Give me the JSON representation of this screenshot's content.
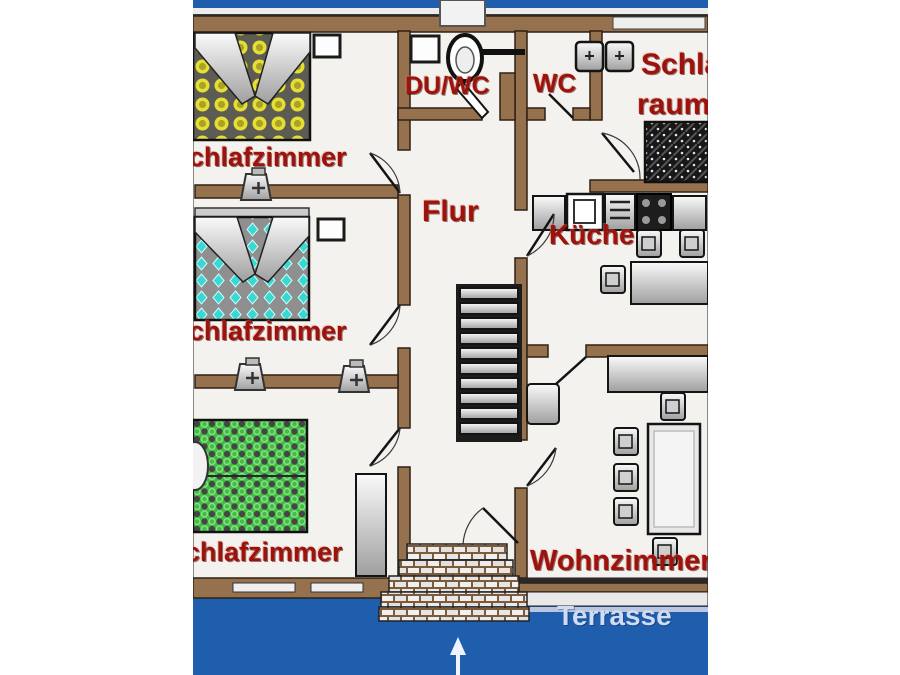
{
  "palette": {
    "page-bg": "#ffffff",
    "scan-blue": "#1f5dad",
    "wall-brown": "#96714d",
    "wall-edge": "#2f2113",
    "plan-white": "#f4f2ee",
    "label-red": "#9c130d",
    "terrace-text": "#cfdcf2"
  },
  "rooms": {
    "bedroom_top": {
      "label": "Schlafzimmer"
    },
    "bedroom_middle": {
      "label": "Schlafzimmer"
    },
    "bedroom_bottom": {
      "label": "Schlafzimmer"
    },
    "hallway": {
      "label": "Flur"
    },
    "shower_wc": {
      "label": "DU/WC"
    },
    "wc": {
      "label": "WC"
    },
    "sleeping_room": {
      "label_line1": "Schlaf",
      "label_line2": "raum"
    },
    "kitchen": {
      "label": "Küche"
    },
    "living_room": {
      "label": "Wohnzimmer"
    }
  },
  "outdoor": {
    "terrace_label": "Terrasse"
  }
}
